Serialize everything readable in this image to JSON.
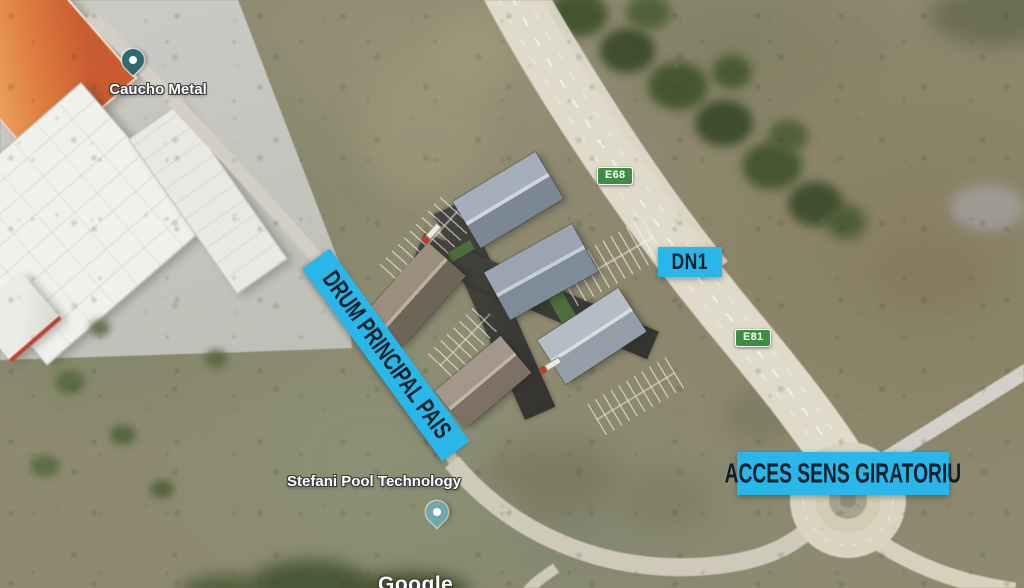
{
  "map": {
    "attribution": "Google",
    "pins": [
      {
        "label": "Caucho Metal",
        "icon": "map-pin-icon",
        "color": "#2e6a70"
      },
      {
        "label": "Stefani Pool Technology",
        "icon": "map-pin-icon",
        "color": "#6fa7ac"
      }
    ],
    "route_badges": [
      {
        "text": "E68"
      },
      {
        "text": "E81"
      }
    ],
    "annotations": {
      "road_name": "DN1",
      "main_road_banner": "DRUM PRINCIPAL PAIS",
      "roundabout_banner": "ACCES SENS GIRATORIU"
    },
    "features": {
      "roundabout": "roundabout",
      "highway": "DN1 / E68 / E81 highway",
      "site": "industrial park 3D render, 5 warehouse buildings"
    },
    "colors": {
      "annotation_cyan": "#29b7ea",
      "route_badge_green": "#3e8e41",
      "site_green_edge": "#46652f",
      "asphalt": "#3c3b37",
      "highway_surface": "#dcd6c3"
    }
  }
}
